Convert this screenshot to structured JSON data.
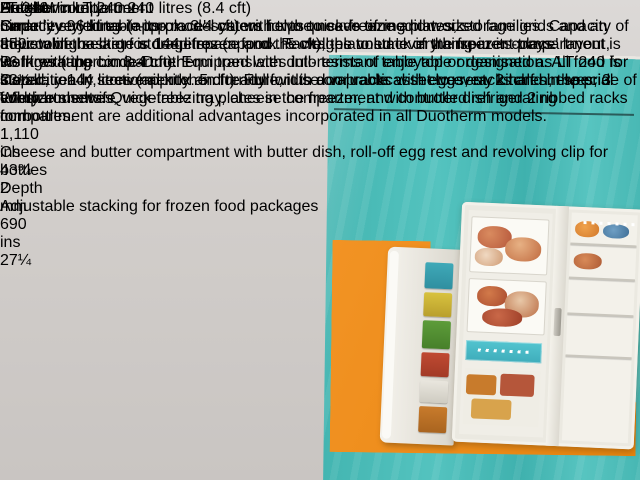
{
  "watermark": {
    "text": "AntiekWinkeltje.net"
  },
  "figure": {
    "label": "2"
  },
  "colors": {
    "teal": "#45b6b2",
    "orange": "#ee8b1a",
    "watermark_red": "#e0251f",
    "paper": "#e8e2d6"
  },
  "left_page": {
    "title": "LT 240",
    "intro": {
      "heading": "Linde 'everything-in-its-place' system helps to save time and work",
      "body": "In view of the large storage space and the well-planned 'everything-in-its-place' layout, work with the Linde-Duotherm translates into terms of enjoyable organisation. All food is stored, ready, conveniently and ready for use on practical shelves, racks and in special compartments. Quick-freezing plates in the freezer, and controlled refrigerating compartment are additional advantages incorporated in all Duotherm models."
    }
  },
  "dimensions": {
    "columns": [
      {
        "label": "Height",
        "mm": "mm 850",
        "ins": "ins 33½"
      },
      {
        "label": "Width",
        "mm": "mm 1,110",
        "ins": "ins 43¾"
      },
      {
        "label": "Depth",
        "mm": "mm 690",
        "ins": "ins 27¼"
      }
    ]
  },
  "model_panel": {
    "model": "Duotherm LT 240",
    "capacity": "240 litres (8.4 cft)",
    "body": "Smartly styled table top model caters for the needs of medium sized families. Capacity of the cooling section is 144 litres (approx. 5 cft), the volume of the freezer compartment is 96 litres (approx. 3.4 cft). Equipped with dull-resistant table top or designed as LT 240 for installation in sectional kitchen furniture, it is a valuable asset to every kitchen, the pride of every housewife."
  },
  "specs": {
    "freezer": {
      "heading": "Freezer compartment",
      "body": "Capacity 96 litres (approx. 3.4 cft) with two quick-freezing plates, storage grids and an adjustable basket for deep frozen food. Packages to stack in transparent trays."
    },
    "refrigerating": {
      "heading": "Refrigerating compartment",
      "body": "Capacity 144 litres (approx. 5 cft). Full-width door racks with egg rest, 2 half shelves, 3 full-size shelves, vegetable tray, cheese compartment with butter dish and 2 ribbed racks for bottles."
    }
  },
  "captions": [
    {
      "number": "1",
      "text": "Cheese and butter compartment with butter dish, roll-off egg rest and revolving clip for bottles"
    },
    {
      "number": "2",
      "text": "Adjustable stacking for frozen food packages"
    }
  ]
}
